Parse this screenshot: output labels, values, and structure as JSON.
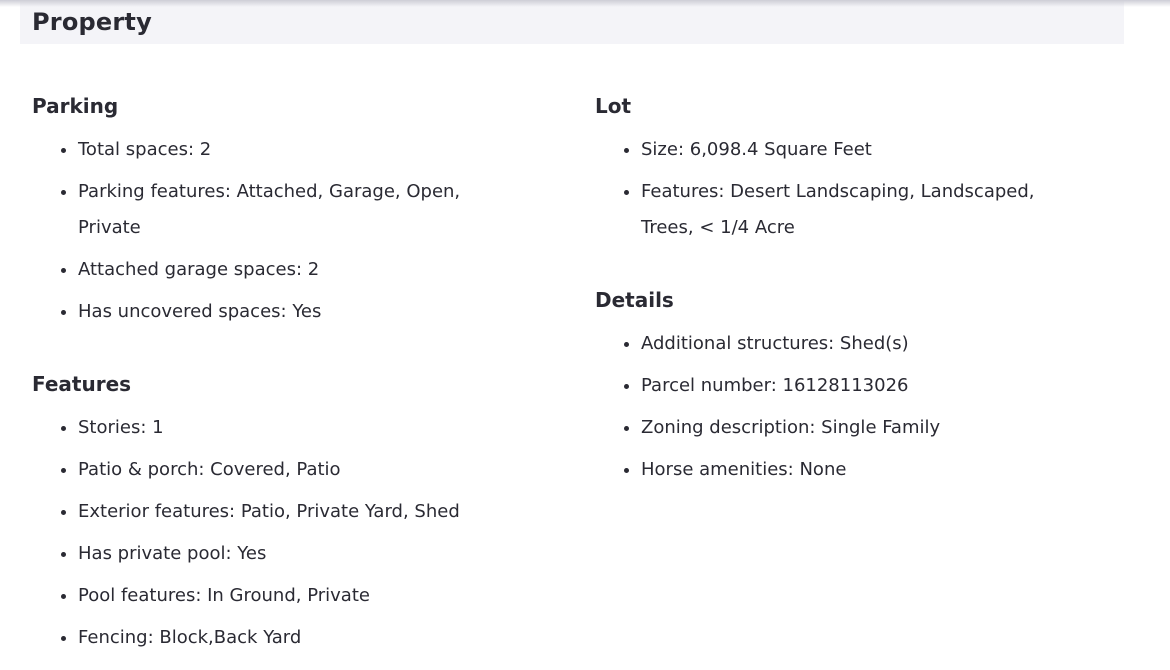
{
  "header": {
    "title": "Property"
  },
  "columns": [
    {
      "sections": [
        {
          "heading": "Parking",
          "items": [
            "Total spaces: 2",
            "Parking features: Attached, Garage, Open, Private",
            "Attached garage spaces: 2",
            "Has uncovered spaces: Yes"
          ]
        },
        {
          "heading": "Features",
          "items": [
            "Stories: 1",
            "Patio & porch: Covered, Patio",
            "Exterior features: Patio, Private Yard, Shed",
            "Has private pool: Yes",
            "Pool features: In Ground, Private",
            "Fencing: Block,Back Yard"
          ]
        }
      ]
    },
    {
      "sections": [
        {
          "heading": "Lot",
          "items": [
            "Size: 6,098.4 Square Feet",
            "Features: Desert Landscaping, Landscaped, Trees, < 1/4 Acre"
          ]
        },
        {
          "heading": "Details",
          "items": [
            "Additional structures: Shed(s)",
            "Parcel number: 16128113026",
            "Zoning description: Single Family",
            "Horse amenities: None"
          ]
        }
      ]
    }
  ],
  "colors": {
    "header_bg": "#f4f4f8",
    "heading_text": "#2a2a33",
    "body_text": "#2a2a33",
    "top_shadow": "#cdcdd6"
  }
}
